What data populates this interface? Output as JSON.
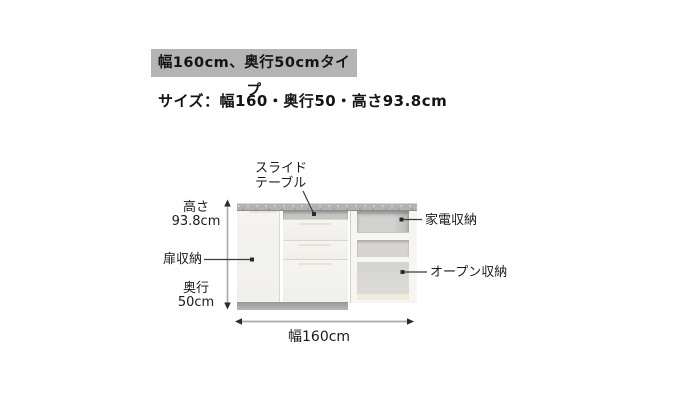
{
  "header": {
    "type_label": "幅160cm、奥行50cmタイプ",
    "size_text": "サイズ：幅160・奥行50・高さ93.8cm"
  },
  "diagram": {
    "product": "キッチンカウンター",
    "labels": {
      "slide_table_line1": "スライド",
      "slide_table_line2": "テーブル",
      "height_line1": "高さ",
      "height_line2": "93.8cm",
      "door_storage": "扉収納",
      "depth_line1": "奥行",
      "depth_line2": "50cm",
      "appliance_storage": "家電収納",
      "open_storage": "オープン収納",
      "width": "幅160cm"
    },
    "dimensions": {
      "width_cm": 160,
      "depth_cm": 50,
      "height_cm": 93.8
    },
    "colors": {
      "type_label_bg": "#b4b4b4",
      "text": "#141414",
      "counter_gray": "#b2b2b2",
      "cabinet_front": "#f3f2ef",
      "compartment_gray": "#d2d2d0",
      "kickbase_gray": "#a8a8a8",
      "arrow_line": "#a8a8a8",
      "arrowhead": "#2e2a28",
      "pointer_line": "#3b3b3b"
    }
  }
}
